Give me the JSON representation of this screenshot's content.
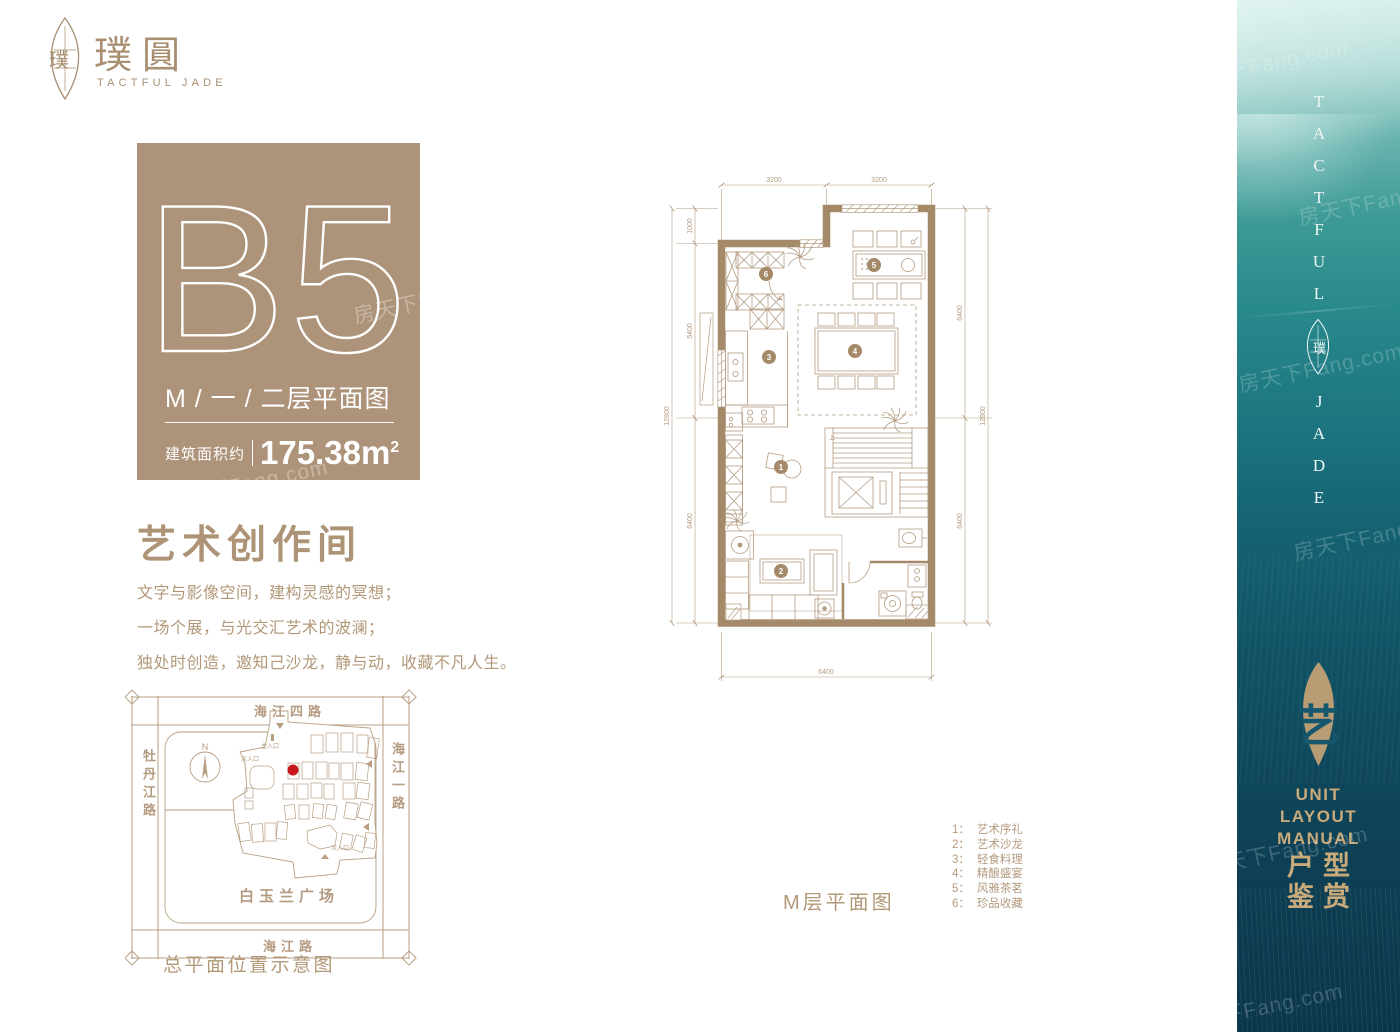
{
  "brand": {
    "logo_cn": "璞圓",
    "logo_en": "TACTFUL JADE",
    "leaf_glyph": "璞"
  },
  "unit_card": {
    "unit_code": "B5",
    "floor_label": "M / 一 / 二层平面图",
    "area_label": "建筑面积约",
    "area_value": "175.38m",
    "area_sup": "2"
  },
  "intro": {
    "title": "艺术创作间",
    "lines": [
      "文字与影像空间，建构灵感的冥想；",
      "一场个展，与光交汇艺术的波澜；",
      "独处时创造，邀知己沙龙，静与动，收藏不凡人生。"
    ]
  },
  "site_map": {
    "road_top": "海江四路",
    "road_left": "牡丹江路",
    "road_right": "海江一路",
    "road_bottom": "海江路",
    "plaza": "白玉兰广场",
    "caption": "总平面位置示意图",
    "compass_n": "N",
    "entrance_main": "主入口",
    "entrance_secondary": "次入口",
    "marker_color": "#c8161d"
  },
  "floor_plan": {
    "caption": "M层平面图",
    "stair_label": "上",
    "badges": [
      "1",
      "2",
      "3",
      "4",
      "5",
      "6"
    ],
    "dims": {
      "top": [
        "3200",
        "3200"
      ],
      "left_inner": [
        "1000",
        "5400",
        "6400"
      ],
      "left_outer": "12800",
      "right_inner": [
        "6400",
        "6400"
      ],
      "right_outer": "12800",
      "bottom": "6400"
    }
  },
  "legend": {
    "items": [
      {
        "num": "1：",
        "label": "艺术序礼"
      },
      {
        "num": "2：",
        "label": "艺术沙龙"
      },
      {
        "num": "3：",
        "label": "轻食料理"
      },
      {
        "num": "4：",
        "label": "精酿盛宴"
      },
      {
        "num": "5：",
        "label": "风雅茶茗"
      },
      {
        "num": "6：",
        "label": "珍品收藏"
      }
    ]
  },
  "side_panel": {
    "vertical_top": "TACTFUL",
    "vertical_bottom": "JADE",
    "art_glyph": "艺",
    "manual_lines": [
      "UNIT",
      "LAYOUT",
      "MANUAL"
    ],
    "cn_rows": [
      "户型",
      "鉴赏"
    ]
  },
  "watermark": "房天下Fang.com",
  "colors": {
    "tan": "#ab9176",
    "tan_light": "#b49b80",
    "wall": "#a58a6a",
    "gold": "#c9aa7b",
    "teal_dark": "#0d3c51",
    "marker_red": "#c8161d"
  }
}
